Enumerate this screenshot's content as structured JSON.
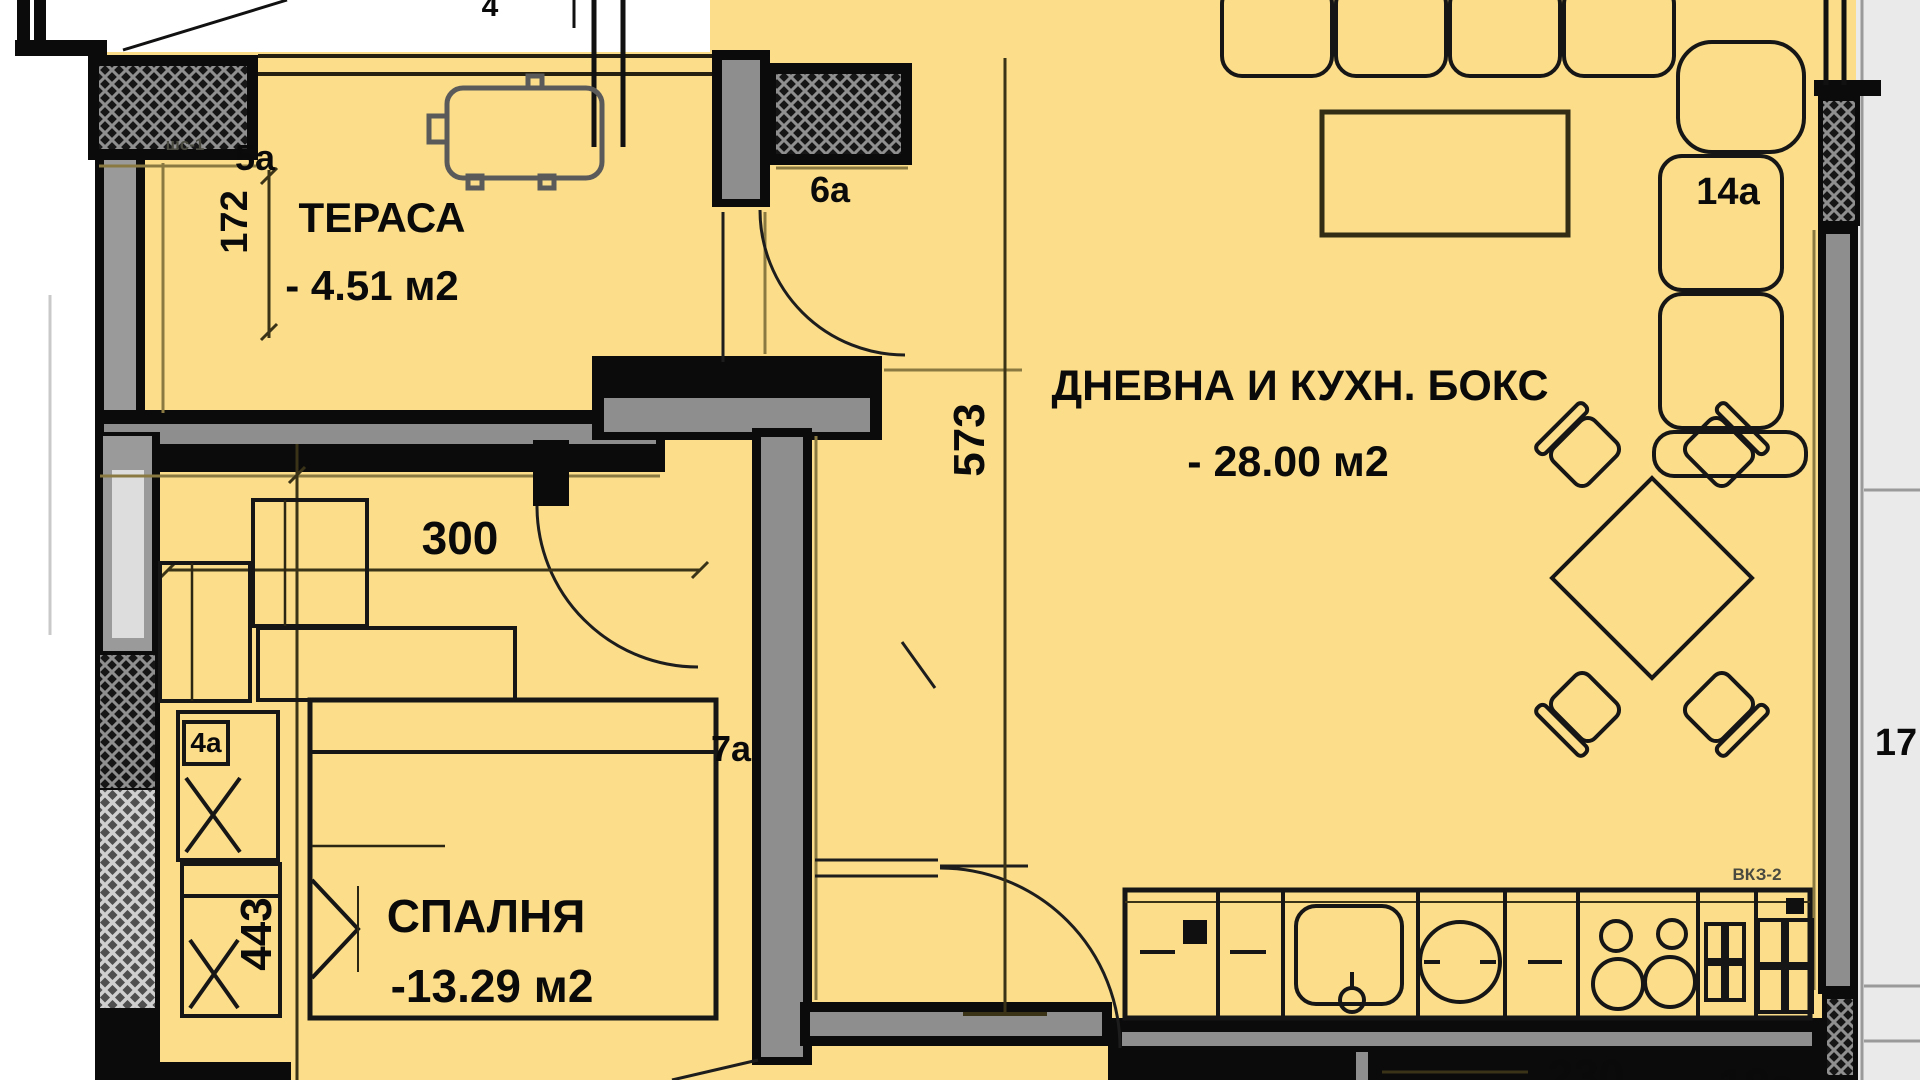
{
  "plan": {
    "rooms": [
      {
        "name": "ТЕРАСА",
        "area": "- 4.51 м2"
      },
      {
        "name": "ДНЕВНА И КУХН. БОКС",
        "area": "- 28.00 м2"
      },
      {
        "name": "СПАЛНЯ",
        "area": "-13.29 м2"
      }
    ],
    "dimensions": {
      "terrace_depth": "172",
      "bedroom_width": "300",
      "living_depth": "573",
      "bedroom_depth": "443",
      "bottom_offset": "230"
    },
    "tags": {
      "t5": "5а",
      "t6": "6а",
      "t7": "7а",
      "t14": "14а",
      "t4": "4а",
      "t17": "17",
      "t18": "18а",
      "shs": "шс-1",
      "vkz": "ВКЗ-2",
      "top_partial": "4"
    },
    "colors": {
      "floor": "#FBDD8A",
      "wall": "#0B0B0B",
      "wall_core": "#8E8E8E",
      "accent_shadow": "#8A7A42",
      "outside_margin": "#EAEAEA",
      "hatch_dark": "#161616",
      "hatch_light": "#4F4F4F"
    }
  }
}
